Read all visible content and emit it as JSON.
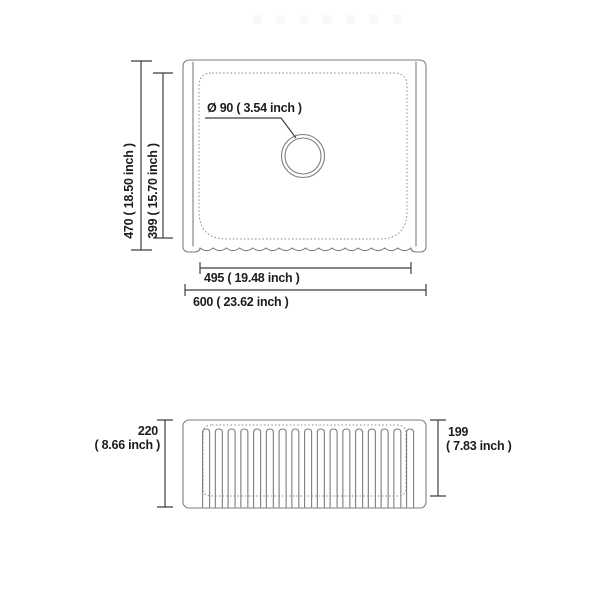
{
  "diagram": {
    "type": "sink-dimension-drawing",
    "colors": {
      "background": "#ffffff",
      "drawing_line": "#7d7d7d",
      "hidden_line": "#8f8f8f",
      "dimension_line": "#3f3f3f",
      "text": "#1c1c1c",
      "watermark": "#f8f8f8"
    },
    "watermark": {
      "square_count": 7
    },
    "top_view": {
      "drain_label": "Ø 90 ( 3.54 inch )",
      "overall_height_label": "470 ( 18.50 inch )",
      "bowl_height_label": "399 ( 15.70 inch )",
      "apron_width_label": "495 ( 19.48 inch )",
      "overall_width_label": "600 ( 23.62 inch )"
    },
    "front_view": {
      "flute_count": 17,
      "overall_height_value": "220",
      "overall_height_inch": "( 8.66 inch )",
      "inner_height_value": "199",
      "inner_height_inch": "( 7.83 inch )"
    }
  }
}
